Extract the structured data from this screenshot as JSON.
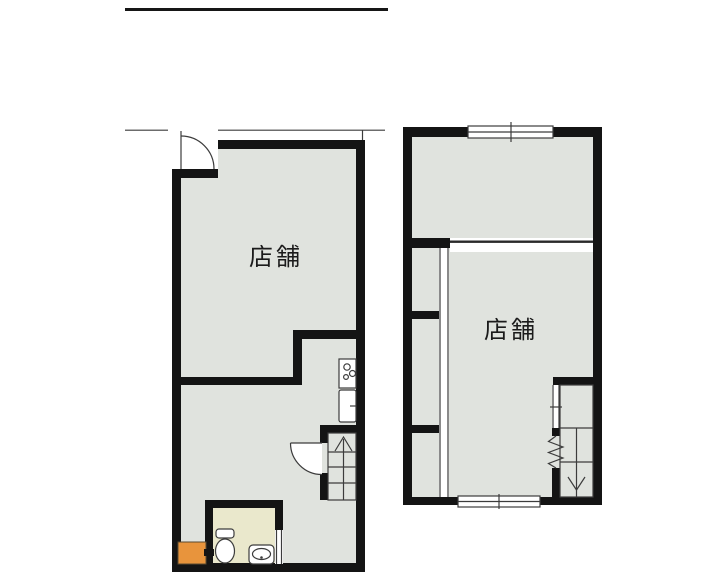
{
  "document": {
    "type": "architectural-floor-plan",
    "floors_count": 2
  },
  "colors": {
    "bg": "#ffffff",
    "wall": "#141414",
    "floor": "#e0e3de",
    "toilet": "#eae8cc",
    "orange": "#e8943c",
    "line": "#3c3c3c"
  },
  "floor1": {
    "room_label": "店舗",
    "fixtures": [
      "entrance-door",
      "kitchen-stove",
      "kitchen-sink",
      "interior-door",
      "staircase-up",
      "toilet",
      "hand-basin",
      "water-heater"
    ]
  },
  "floor2": {
    "room_label": "店舗",
    "fixtures": [
      "window-top",
      "window-bottom",
      "closet-column",
      "sliding-door-track",
      "stair-door",
      "staircase-down"
    ]
  }
}
